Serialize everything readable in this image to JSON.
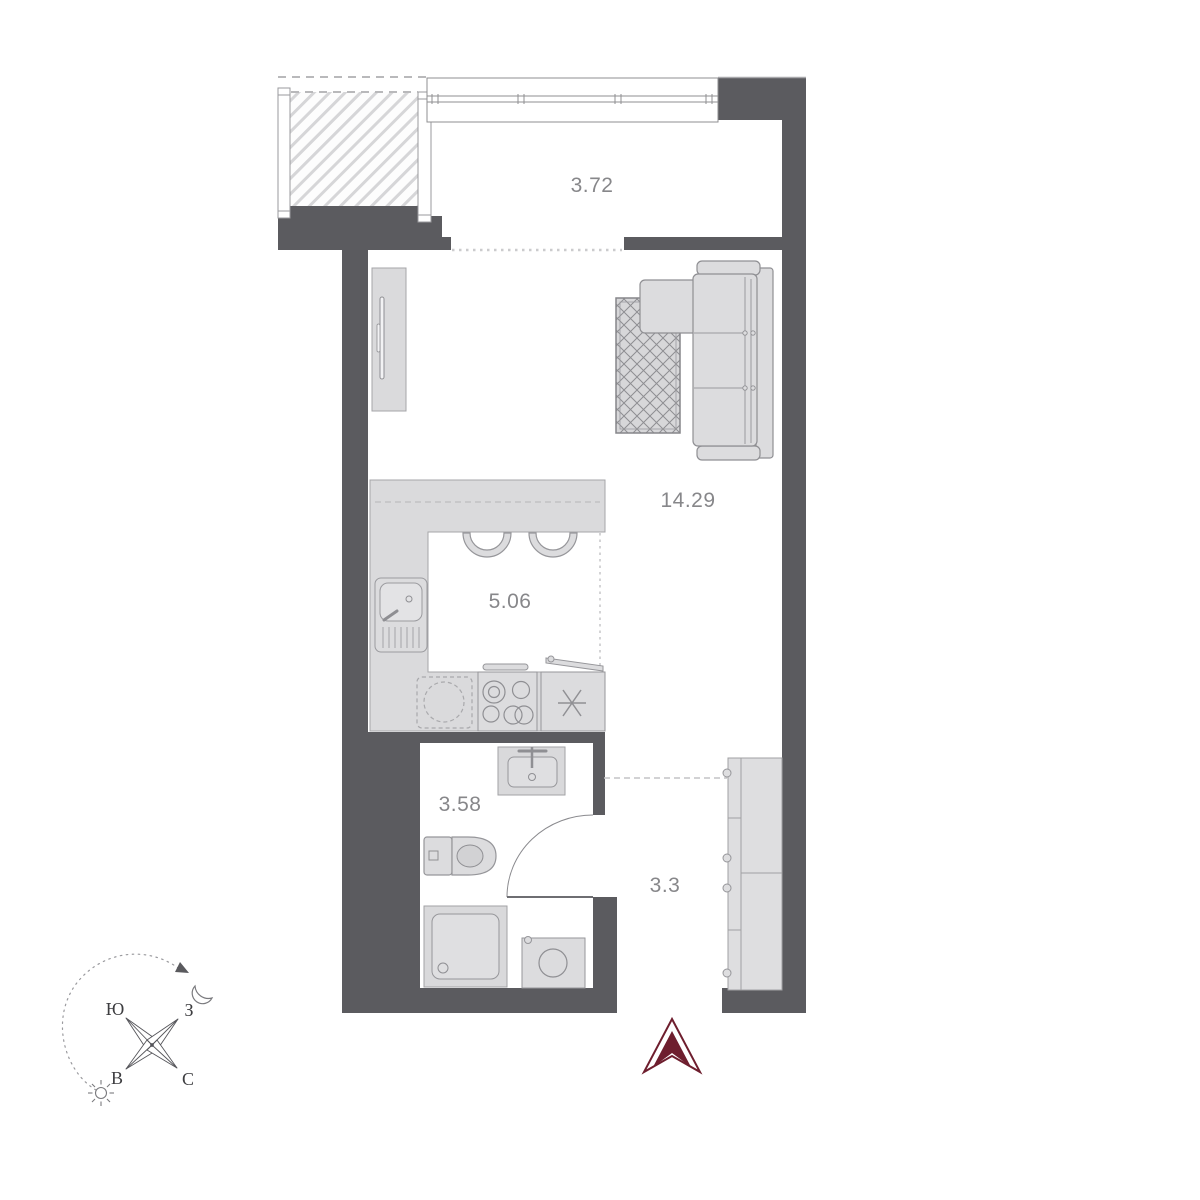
{
  "floor_plan": {
    "rooms": [
      {
        "id": "loggia",
        "area_label": "3.72"
      },
      {
        "id": "living-room",
        "area_label": "14.29"
      },
      {
        "id": "kitchen",
        "area_label": "5.06"
      },
      {
        "id": "bathroom",
        "area_label": "3.58"
      },
      {
        "id": "hallway",
        "area_label": "3.3"
      }
    ],
    "compass": {
      "south": "Ю",
      "west": "З",
      "east": "В",
      "north": "С"
    },
    "colors": {
      "wall": "#5b5b5f",
      "furniture_fill": "#dcdcde",
      "furniture_stroke": "#9b9b9f",
      "entry_arrow": "#6e1e2e",
      "room_label_text": "#87878a"
    }
  }
}
